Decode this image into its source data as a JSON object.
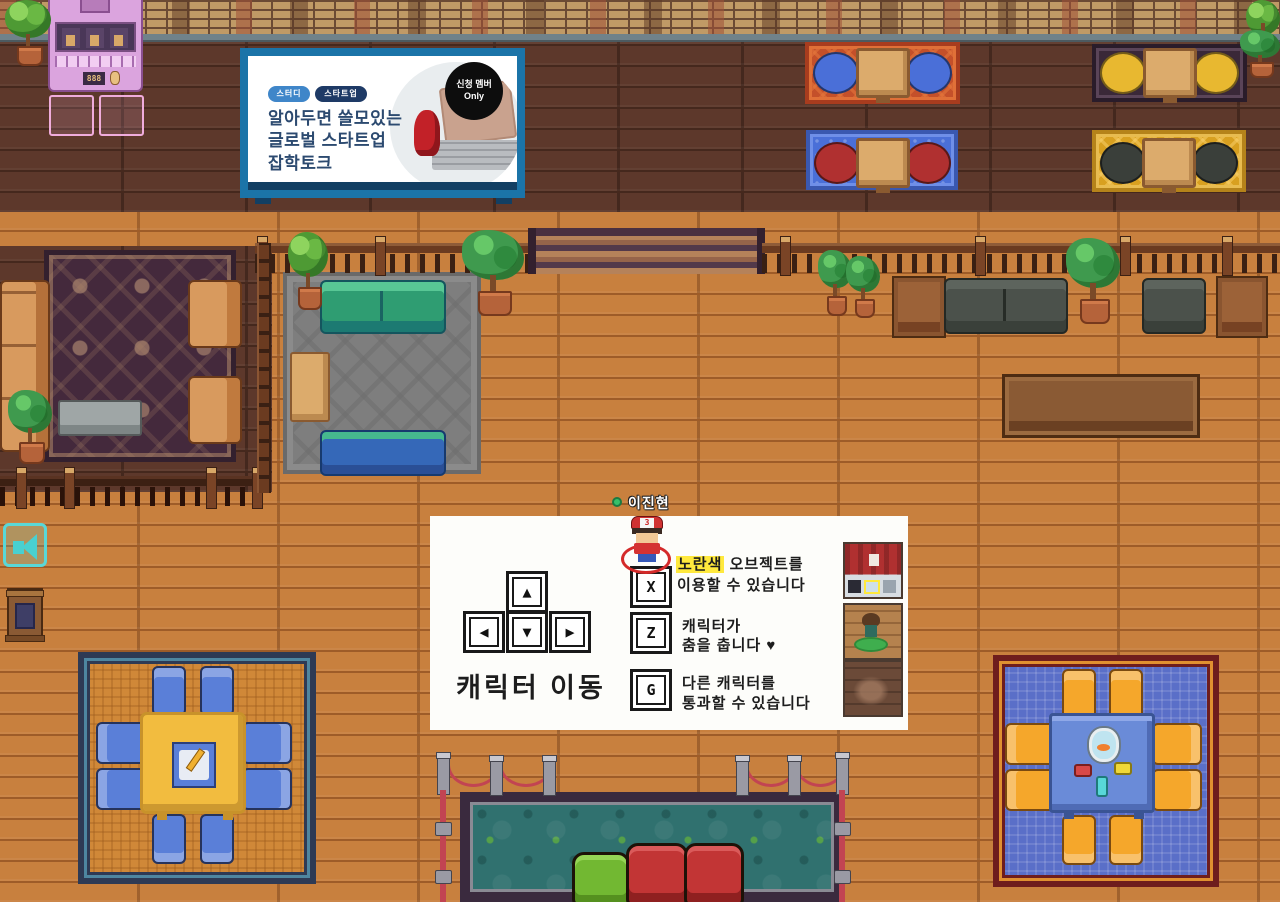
{
  "billboard": {
    "badge1": "스터디",
    "badge2": "스타트업",
    "title": "알아두면 쓸모있는\n글로벌 스타트업\n잡학토크",
    "circle_line1": "신청 멤버",
    "circle_line2": "Only"
  },
  "player": {
    "name": "이진현",
    "cap_number": "3",
    "status": "online"
  },
  "guide": {
    "move_label": "캐릭터 이동",
    "key_up": "▲",
    "key_left": "◀",
    "key_down": "▼",
    "key_right": "▶",
    "x_key": "X",
    "x_highlight": "노란색",
    "x_rest": " 오브젝트를",
    "x_line2": "이용할 수 있습니다",
    "z_key": "Z",
    "z_line1": "캐릭터가",
    "z_line2": "춤을 춥니다 ♥",
    "g_key": "G",
    "g_line1": "다른 캐릭터를",
    "g_line2": "통과할 수 있습니다"
  },
  "vending": {
    "display": "888"
  },
  "icons": {
    "megaphone": "announcement-zone",
    "whiteboard": "shared-whiteboard",
    "fishbowl": "fishbowl-object"
  },
  "colors": {
    "billboard_frame": "#1b74a8",
    "highlight_yellow": "#ffe93d",
    "status_green": "#35c06a",
    "floor_light": "#c8803e",
    "floor_dark": "#5d382b",
    "pond_teal": "#30716f",
    "rope_red": "#c24452"
  }
}
